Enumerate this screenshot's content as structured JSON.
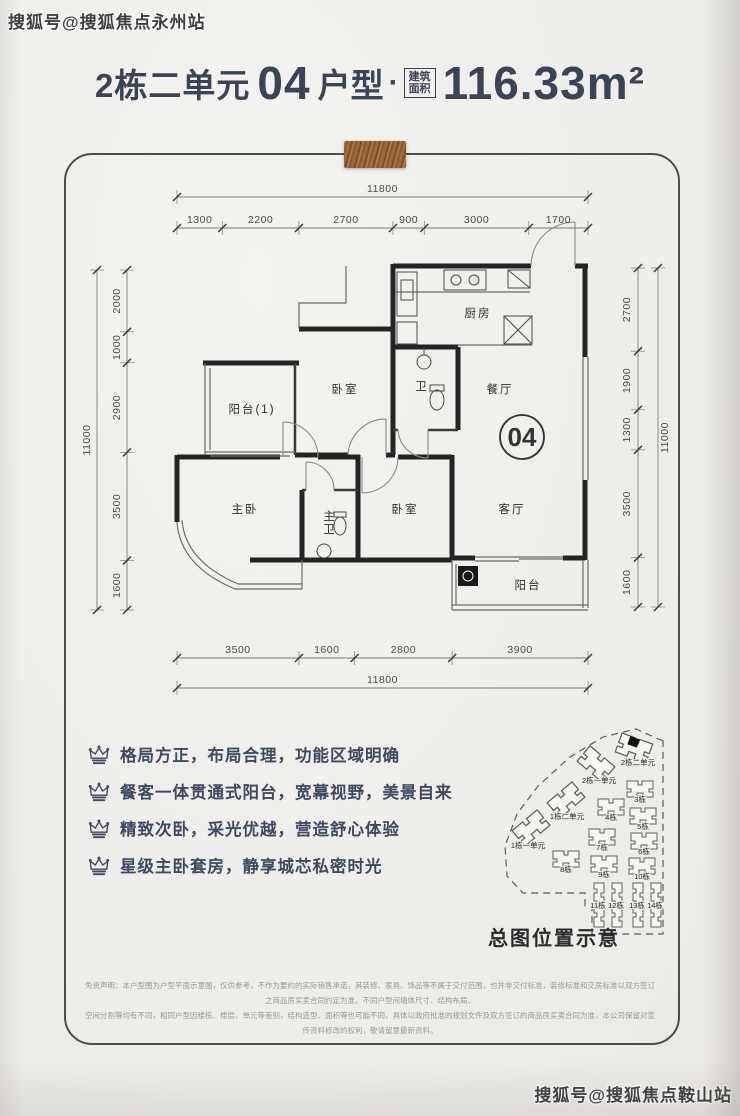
{
  "watermarks": {
    "top_left": "搜狐号@搜狐焦点永州站",
    "bottom_right": "搜狐号@搜狐焦点鞍山站"
  },
  "header": {
    "building": "2栋二单元",
    "unit_number": "04",
    "unit_type": "户型",
    "separator": "·",
    "area_label_line1": "建筑",
    "area_label_line2": "面积",
    "area_value": "116.33",
    "area_unit": "m²"
  },
  "floorplan": {
    "unit_badge": "04",
    "rooms": [
      {
        "name": "阳台(1)",
        "x": 252,
        "y": 413
      },
      {
        "name": "卧室",
        "x": 345,
        "y": 393
      },
      {
        "name": "卫",
        "x": 422,
        "y": 390
      },
      {
        "name": "厨房",
        "x": 478,
        "y": 317
      },
      {
        "name": "餐厅",
        "x": 500,
        "y": 393
      },
      {
        "name": "客厅",
        "x": 512,
        "y": 513
      },
      {
        "name": "主卧",
        "x": 245,
        "y": 513
      },
      {
        "name": "主卫",
        "x": 330,
        "y": 520,
        "vertical": true
      },
      {
        "name": "卧室",
        "x": 405,
        "y": 513
      },
      {
        "name": "阳台",
        "x": 528,
        "y": 589
      }
    ],
    "dimensions": {
      "top": {
        "total": "11800",
        "segments": [
          "1300",
          "2200",
          "2700",
          "900",
          "3000",
          "1700"
        ]
      },
      "bottom": {
        "total": "11800",
        "segments": [
          "3500",
          "1600",
          "2800",
          "3900"
        ]
      },
      "left": {
        "total": "11000",
        "segments": [
          "2000",
          "1000",
          "2900",
          "3500",
          "1600"
        ]
      },
      "right": {
        "total": "11000",
        "segments": [
          "2700",
          "1900",
          "1300",
          "3500",
          "1600"
        ]
      }
    }
  },
  "features": {
    "items": [
      "格局方正，布局合理，功能区域明确",
      "餐客一体贯通式阳台，宽幕视野，美景自来",
      "精致次卧，采光优越，营造舒心体验",
      "星级主卧套房，静享城芯私密时光"
    ]
  },
  "sitemap": {
    "title": "总图位置示意",
    "buildings": [
      {
        "label": "2栋二单元",
        "x": 634,
        "y": 748,
        "type": "unit",
        "rot": 20,
        "highlight": true,
        "lx": 638,
        "ly": 765
      },
      {
        "label": "2栋一单元",
        "x": 596,
        "y": 764,
        "type": "unit",
        "rot": 40,
        "lx": 599,
        "ly": 783
      },
      {
        "label": "1栋二单元",
        "x": 566,
        "y": 800,
        "type": "unit",
        "rot": -40,
        "lx": 567,
        "ly": 819
      },
      {
        "label": "1栋一单元",
        "x": 531,
        "y": 828,
        "type": "unit",
        "rot": -40,
        "lx": 528,
        "ly": 848
      },
      {
        "label": "3栋",
        "x": 640,
        "y": 789,
        "type": "block",
        "rot": 0,
        "lx": 640,
        "ly": 802
      },
      {
        "label": "4栋",
        "x": 611,
        "y": 807,
        "type": "block",
        "rot": 0,
        "lx": 611,
        "ly": 820
      },
      {
        "label": "5栋",
        "x": 643,
        "y": 816,
        "type": "block",
        "rot": 0,
        "lx": 643,
        "ly": 829
      },
      {
        "label": "7栋",
        "x": 602,
        "y": 837,
        "type": "block",
        "rot": 0,
        "lx": 602,
        "ly": 850
      },
      {
        "label": "6栋",
        "x": 644,
        "y": 841,
        "type": "block",
        "rot": 0,
        "lx": 644,
        "ly": 854
      },
      {
        "label": "8栋",
        "x": 566,
        "y": 859,
        "type": "block",
        "rot": 0,
        "lx": 566,
        "ly": 872
      },
      {
        "label": "9栋",
        "x": 604,
        "y": 864,
        "type": "block",
        "rot": 0,
        "lx": 604,
        "ly": 877
      },
      {
        "label": "10栋",
        "x": 642,
        "y": 866,
        "type": "block",
        "rot": 0,
        "lx": 642,
        "ly": 879
      },
      {
        "label": "11栋",
        "x": 599,
        "y": 905,
        "type": "tower",
        "rot": 0,
        "lx": 598,
        "ly": 908
      },
      {
        "label": "12栋",
        "x": 617,
        "y": 905,
        "type": "tower",
        "rot": 0,
        "lx": 616,
        "ly": 908
      },
      {
        "label": "13栋",
        "x": 638,
        "y": 905,
        "type": "tower",
        "rot": 0,
        "lx": 637,
        "ly": 908
      },
      {
        "label": "14栋",
        "x": 656,
        "y": 905,
        "type": "tower",
        "rot": 0,
        "lx": 655,
        "ly": 908
      }
    ]
  },
  "disclaimer": {
    "line1": "免责声明：本户型图为户型平面示意图，仅供参考，不作为要约的实际销售承诺，其装修、家具、饰品等不属于交付范围，也并非交付标准，装修标准和交房标准以双方签订之商品房买卖合同约定为准。不同户型间墙体尺寸、结构布局、",
    "line2": "空间分割等均有不同，相同户型因楼栋、楼层、单元等差别，结构造型、面积等也可能不同，具体以政府批准的规划文件及双方签订的商品房买卖合同为准，本公司保留对宣传资料修改的权利，敬请留意最新资料。"
  }
}
